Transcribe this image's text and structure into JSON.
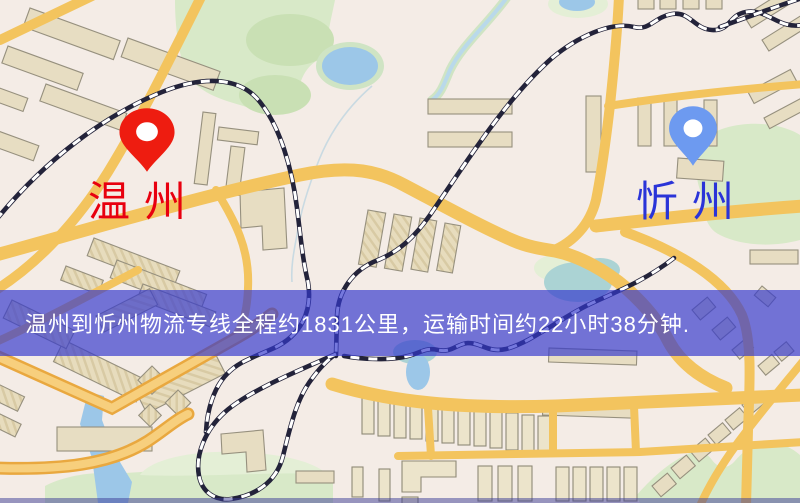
{
  "map": {
    "origin": {
      "name": "温州",
      "pin_color": "#ee1c10",
      "label_color": "#e8000f"
    },
    "destination": {
      "name": "忻州",
      "pin_color": "#6d9af0",
      "label_color": "#2a34d8"
    },
    "banner": {
      "text": "温州到忻州物流专线全程约1831公里，运输时间约22小时38分钟.",
      "background": "rgba(52,56,205,0.68)",
      "text_color": "#ffffff"
    },
    "theme": {
      "land": "#f4ece6",
      "road": "#f3c45e",
      "building": "#e7ddc2",
      "park": "#d8e9c8",
      "water": "#9cc7e8",
      "railway": "#23233a"
    }
  }
}
